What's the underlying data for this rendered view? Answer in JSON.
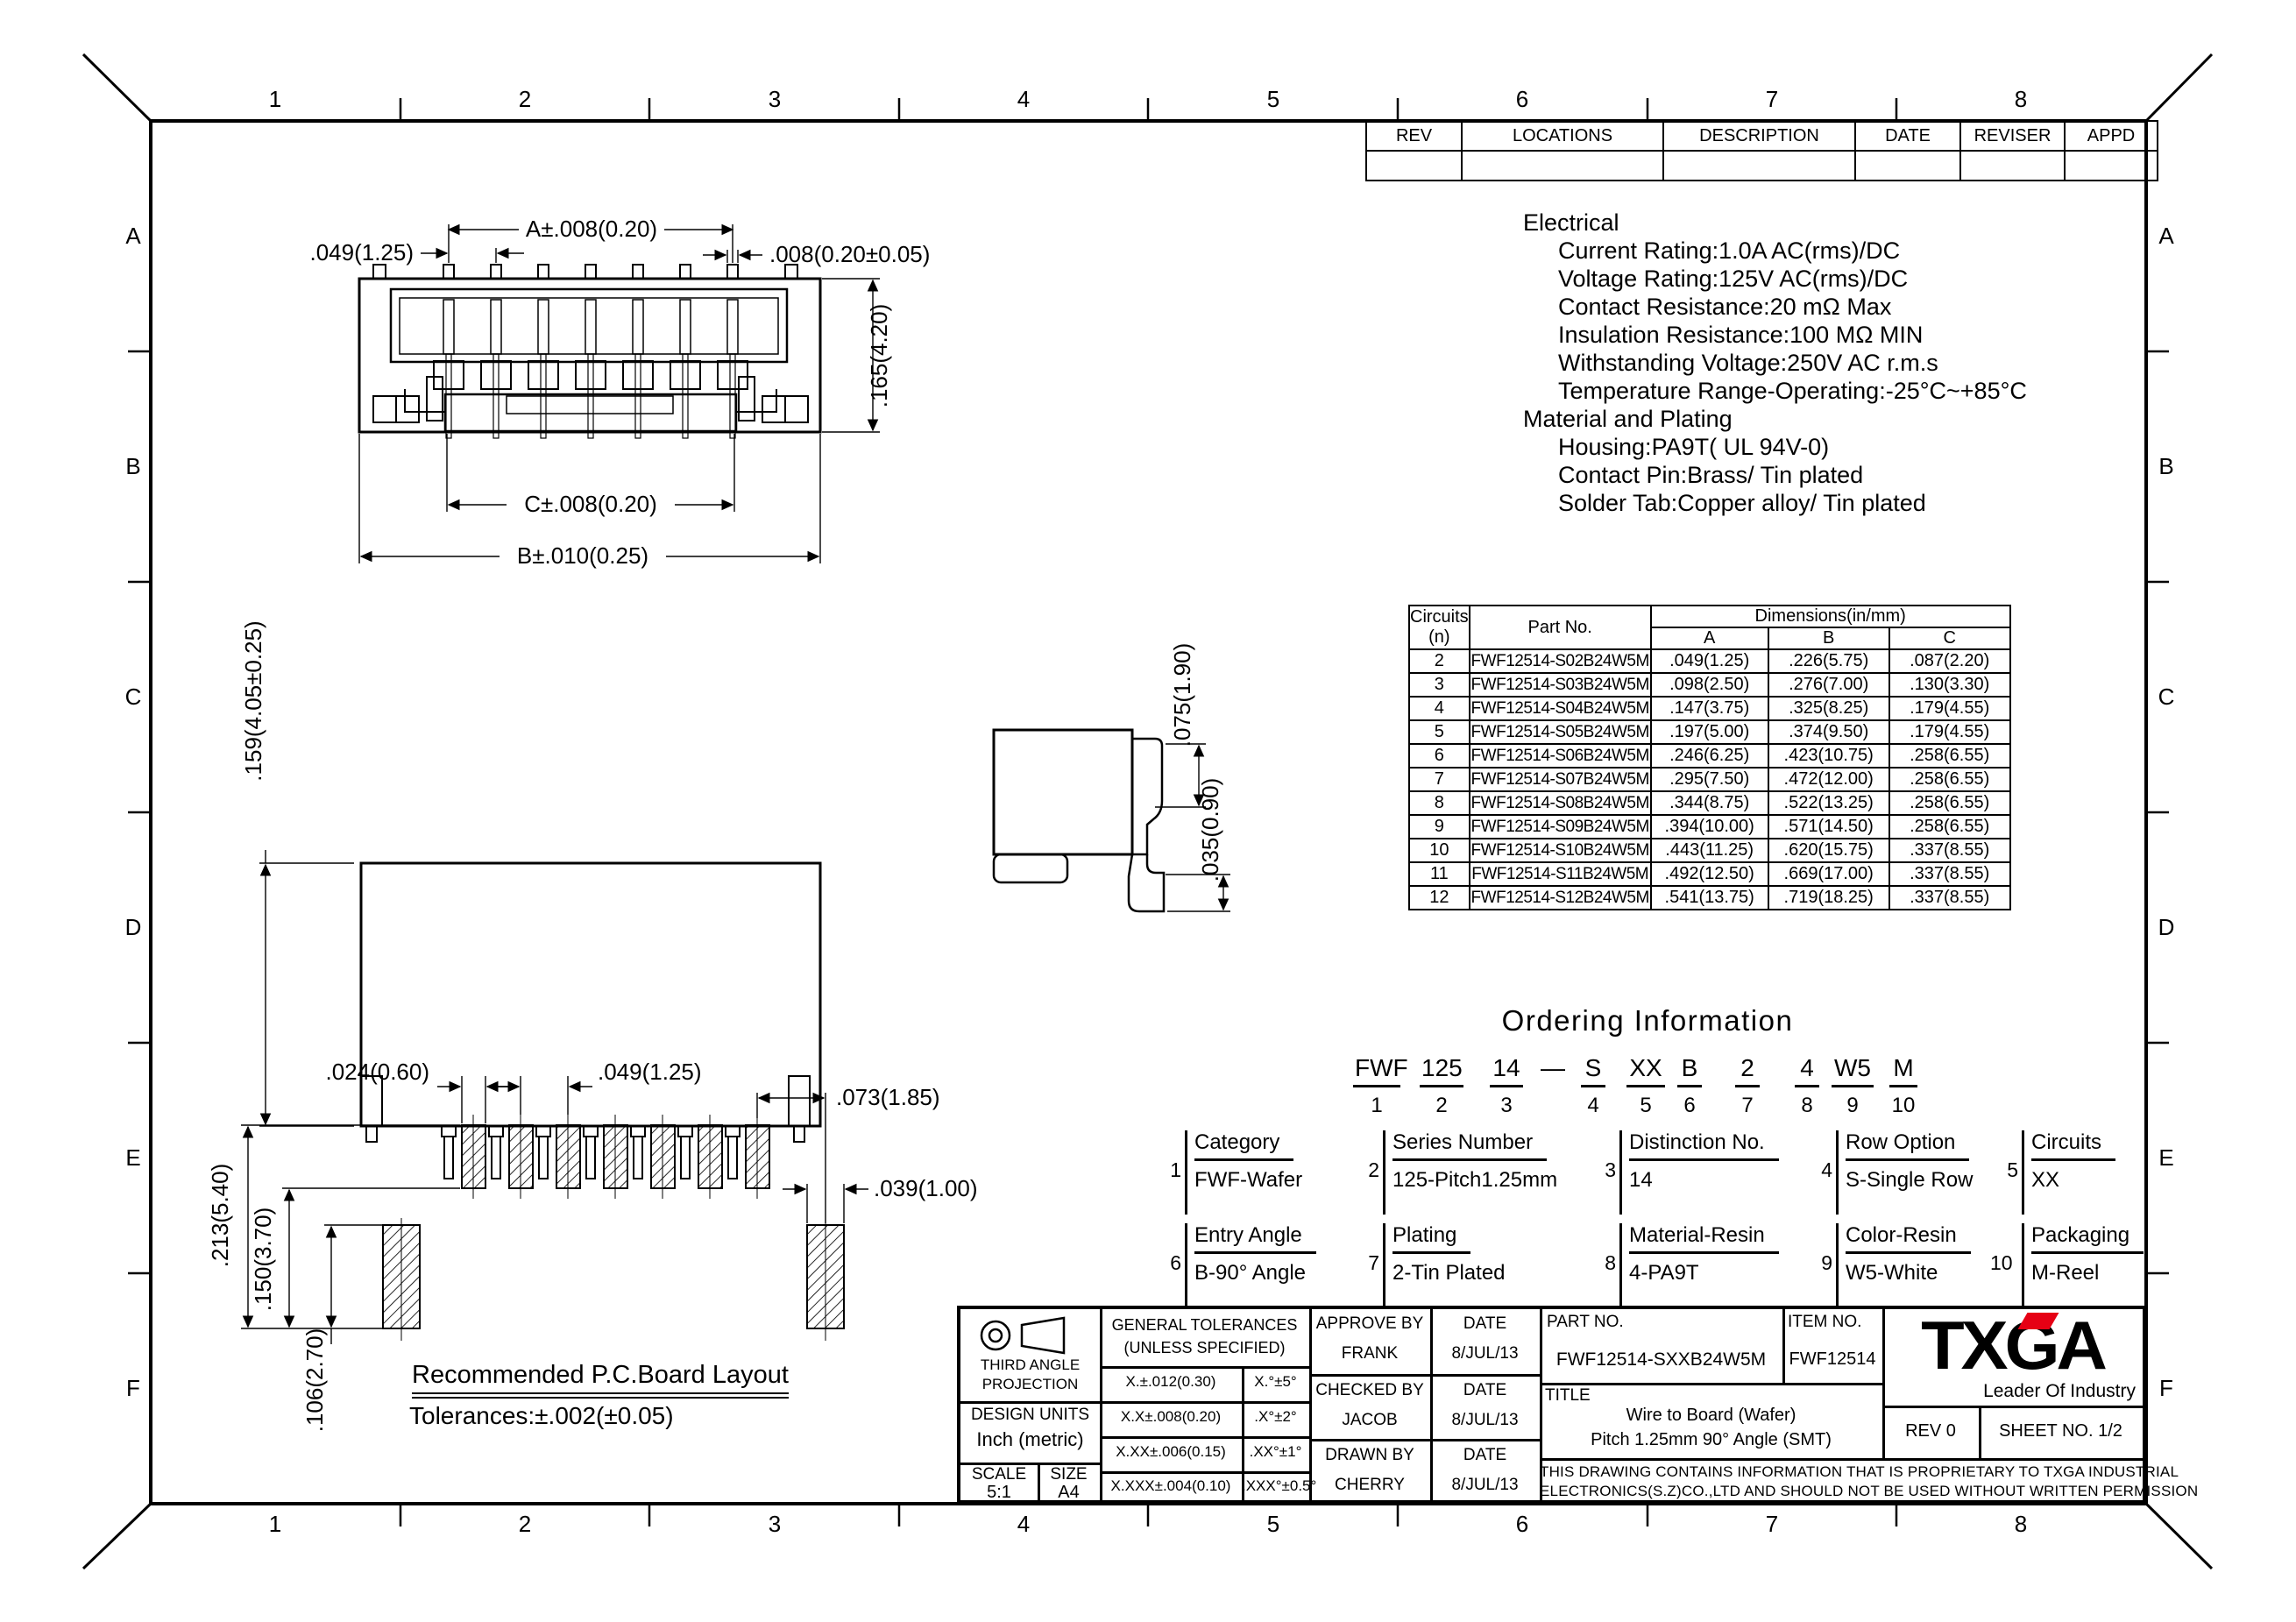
{
  "border": {
    "cols": [
      "1",
      "2",
      "3",
      "4",
      "5",
      "6",
      "7",
      "8"
    ],
    "rows": [
      "A",
      "B",
      "C",
      "D",
      "E",
      "F"
    ]
  },
  "rev_table": {
    "headers": [
      "REV",
      "LOCATIONS",
      "DESCRIPTION",
      "DATE",
      "REVISER",
      "APPD"
    ]
  },
  "electrical": {
    "title": "Electrical",
    "lines": [
      "Current Rating:1.0A AC(rms)/DC",
      "Voltage Rating:125V AC(rms)/DC",
      "Contact Resistance:20 mΩ Max",
      "Insulation Resistance:100 MΩ MIN",
      "Withstanding Voltage:250V AC r.m.s",
      "Temperature Range-Operating:-25°C~+85°C"
    ],
    "material_title": "Material and Plating",
    "material_lines": [
      "Housing:PA9T( UL 94V-0)",
      "Contact Pin:Brass/ Tin plated",
      "Solder Tab:Copper alloy/ Tin plated"
    ]
  },
  "dims_table": {
    "header": {
      "circuits_1": "Circuits",
      "circuits_2": "(n)",
      "part": "Part No.",
      "dims": "Dimensions(in/mm)",
      "a": "A",
      "b": "B",
      "c": "C"
    },
    "rows": [
      {
        "n": "2",
        "part": "FWF12514-S02B24W5M",
        "a": ".049(1.25)",
        "b": ".226(5.75)",
        "c": ".087(2.20)"
      },
      {
        "n": "3",
        "part": "FWF12514-S03B24W5M",
        "a": ".098(2.50)",
        "b": ".276(7.00)",
        "c": ".130(3.30)"
      },
      {
        "n": "4",
        "part": "FWF12514-S04B24W5M",
        "a": ".147(3.75)",
        "b": ".325(8.25)",
        "c": ".179(4.55)"
      },
      {
        "n": "5",
        "part": "FWF12514-S05B24W5M",
        "a": ".197(5.00)",
        "b": ".374(9.50)",
        "c": ".179(4.55)"
      },
      {
        "n": "6",
        "part": "FWF12514-S06B24W5M",
        "a": ".246(6.25)",
        "b": ".423(10.75)",
        "c": ".258(6.55)"
      },
      {
        "n": "7",
        "part": "FWF12514-S07B24W5M",
        "a": ".295(7.50)",
        "b": ".472(12.00)",
        "c": ".258(6.55)"
      },
      {
        "n": "8",
        "part": "FWF12514-S08B24W5M",
        "a": ".344(8.75)",
        "b": ".522(13.25)",
        "c": ".258(6.55)"
      },
      {
        "n": "9",
        "part": "FWF12514-S09B24W5M",
        "a": ".394(10.00)",
        "b": ".571(14.50)",
        "c": ".258(6.55)"
      },
      {
        "n": "10",
        "part": "FWF12514-S10B24W5M",
        "a": ".443(11.25)",
        "b": ".620(15.75)",
        "c": ".337(8.55)"
      },
      {
        "n": "11",
        "part": "FWF12514-S11B24W5M",
        "a": ".492(12.50)",
        "b": ".669(17.00)",
        "c": ".337(8.55)"
      },
      {
        "n": "12",
        "part": "FWF12514-S12B24W5M",
        "a": ".541(13.75)",
        "b": ".719(18.25)",
        "c": ".337(8.55)"
      }
    ]
  },
  "ordering": {
    "title": "Ordering Information",
    "dash": "—",
    "segments": [
      {
        "code": "FWF",
        "num": "1"
      },
      {
        "code": "125",
        "num": "2"
      },
      {
        "code": "14",
        "num": "3"
      },
      {
        "code": "S",
        "num": "4"
      },
      {
        "code": "XX",
        "num": "5"
      },
      {
        "code": "B",
        "num": "6"
      },
      {
        "code": "2",
        "num": "7"
      },
      {
        "code": "4",
        "num": "8"
      },
      {
        "code": "W5",
        "num": "9"
      },
      {
        "code": "M",
        "num": "10"
      }
    ],
    "fields": [
      {
        "num": "1",
        "label": "Category",
        "value": "FWF-Wafer"
      },
      {
        "num": "2",
        "label": "Series Number",
        "value": "125-Pitch1.25mm"
      },
      {
        "num": "3",
        "label": "Distinction No.",
        "value": "14"
      },
      {
        "num": "4",
        "label": "Row Option",
        "value": "S-Single Row"
      },
      {
        "num": "5",
        "label": "Circuits",
        "value": "XX"
      },
      {
        "num": "6",
        "label": "Entry Angle",
        "value": "B-90° Angle"
      },
      {
        "num": "7",
        "label": "Plating",
        "value": "2-Tin Plated"
      },
      {
        "num": "8",
        "label": "Material-Resin",
        "value": "4-PA9T"
      },
      {
        "num": "9",
        "label": "Color-Resin",
        "value": "W5-White"
      },
      {
        "num": "10",
        "label": "Packaging",
        "value": "M-Reel"
      }
    ]
  },
  "pcb": {
    "title": "Recommended P.C.Board Layout",
    "tolerance": "Tolerances:±.002(±0.05)"
  },
  "dim_labels": {
    "tv_a": "A±.008(0.20)",
    "tv_pitch": ".049(1.25)",
    "tv_pin": ".008(0.20±0.05)",
    "tv_h": ".165(4.20)",
    "tv_c": "C±.008(0.20)",
    "tv_b": "B±.010(0.25)",
    "fv_h": ".159(4.05±0.25)",
    "sv_plate": ".075(1.90)",
    "sv_tab": ".035(0.90)",
    "pcb_padw": ".024(0.60)",
    "pcb_pitch": ".049(1.25)",
    "pcb_last": ".073(1.85)",
    "pcb_tabw": ".039(1.00)",
    "pcb_h1": ".213(5.40)",
    "pcb_h2": ".150(3.70)",
    "pcb_h3": ".106(2.70)"
  },
  "title_block": {
    "proj_line1": "THIRD ANGLE",
    "proj_line2": "PROJECTION",
    "design_units_label": "DESIGN UNITS",
    "design_units_value": "Inch (metric)",
    "scale_label": "SCALE",
    "scale_value": "5:1",
    "size_label": "SIZE",
    "size_value": "A4",
    "gt_line1": "GENERAL TOLERANCES",
    "gt_line2": "(UNLESS SPECIFIED)",
    "gt_rows": [
      {
        "lin": "X.±.012(0.30)",
        "ang": "X.°±5°"
      },
      {
        "lin": "X.X±.008(0.20)",
        "ang": ".X°±2°"
      },
      {
        "lin": "X.XX±.006(0.15)",
        "ang": ".XX°±1°"
      },
      {
        "lin": "X.XXX±.004(0.10)",
        "ang": ".XXX°±0.5°"
      }
    ],
    "approvals": [
      {
        "role": "APPROVE BY",
        "name": "FRANK",
        "date_label": "DATE",
        "date": "8/JUL/13"
      },
      {
        "role": "CHECKED BY",
        "name": "JACOB",
        "date_label": "DATE",
        "date": "8/JUL/13"
      },
      {
        "role": "DRAWN BY",
        "name": "CHERRY",
        "date_label": "DATE",
        "date": "8/JUL/13"
      }
    ],
    "part_no_label": "PART NO.",
    "part_no_value": "FWF12514-SXXB24W5M",
    "item_no_label": "ITEM NO.",
    "item_no_value": "FWF12514",
    "title_label": "TITLE",
    "title_line1": "Wire to Board (Wafer)",
    "title_line2": "Pitch 1.25mm 90° Angle (SMT)",
    "logo_text": "TXGA",
    "logo_tagline": "Leader Of Industry",
    "logo_accent": "#e60014",
    "rev": "REV 0",
    "sheet": "SHEET NO. 1/2",
    "notice1": "THIS DRAWING CONTAINS INFORMATION THAT IS PROPRIETARY TO TXGA INDUSTRIAL",
    "notice2": "ELECTRONICS(S.Z)CO.,LTD AND SHOULD NOT BE USED WITHOUT WRITTEN PERMISSION"
  }
}
